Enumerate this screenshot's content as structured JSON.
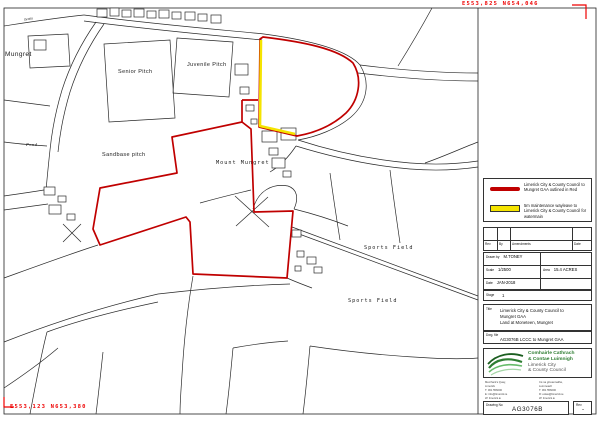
{
  "coords": {
    "top_right": "E553,825 N654,046",
    "bottom_left": "E553,123 N653,380"
  },
  "map_labels": {
    "mungret": "Mungret",
    "grotto": "Grotto",
    "senior_pitch": "Senior Pitch",
    "juvenile_pitch": "Juvenile Pitch",
    "sandbase_pitch": "Sandbase pitch",
    "mount_mungret": "Mount Mungret",
    "pond": "Pond",
    "sports_field_1": "Sports Field",
    "sports_field_2": "Sports Field"
  },
  "legend": {
    "item1_text": "Limerick City & County Council to Mungret GAA outlined in Red",
    "item2_text": "5m maintenance wayleave to Limerick City & County Council for watermain"
  },
  "revision_table": {
    "rev": "Rev",
    "by": "By",
    "amendments": "Amendments",
    "date": "Date"
  },
  "info": {
    "drawn_by_label": "Drawn by",
    "drawn_by_value": "M.TONEY",
    "scale_label": "Scale",
    "scale_value": "1/2500",
    "area_label": "Area",
    "area_value": "15.4 ACRES",
    "date_label": "Date",
    "date_value": "JAN-2018",
    "stage_label": "Stage",
    "stage_value": "1"
  },
  "title_block": {
    "label": "Title",
    "line1": "Limerick City & County Council to",
    "line2": "Mungret GAA",
    "line3": "Land at Moneteen, Mungret"
  },
  "dwg_file": {
    "label": "Dwg. file",
    "value": "AG3076B LCCC to Mungret GAA"
  },
  "council": {
    "irish_name_line1": "Comhairle Cathrach",
    "irish_name_line2": "& Contae Luimnigh",
    "english_name_line1": "Limerick City",
    "english_name_line2": "& County Council",
    "address_left": [
      "Merchant's Quay,",
      "Limerick",
      "T: 061 556000",
      "E: info@limerick.ie",
      "W: limerick.ie"
    ],
    "address_right": [
      "Cé na gCeannaithe,",
      "Luimneach",
      "T: 061 556000",
      "R: eolas@limerick.ie",
      "W: limerick.ie"
    ]
  },
  "drawing_no_box": {
    "label": "Drawing No",
    "value": "AG3076B"
  },
  "rev_box": {
    "label": "Rev",
    "value": "-"
  },
  "colors": {
    "boundary_red": "#c00000",
    "wayleave_yellow": "#f5e400",
    "coordinate_red": "#ee0000",
    "council_green": "#2e7d32"
  }
}
